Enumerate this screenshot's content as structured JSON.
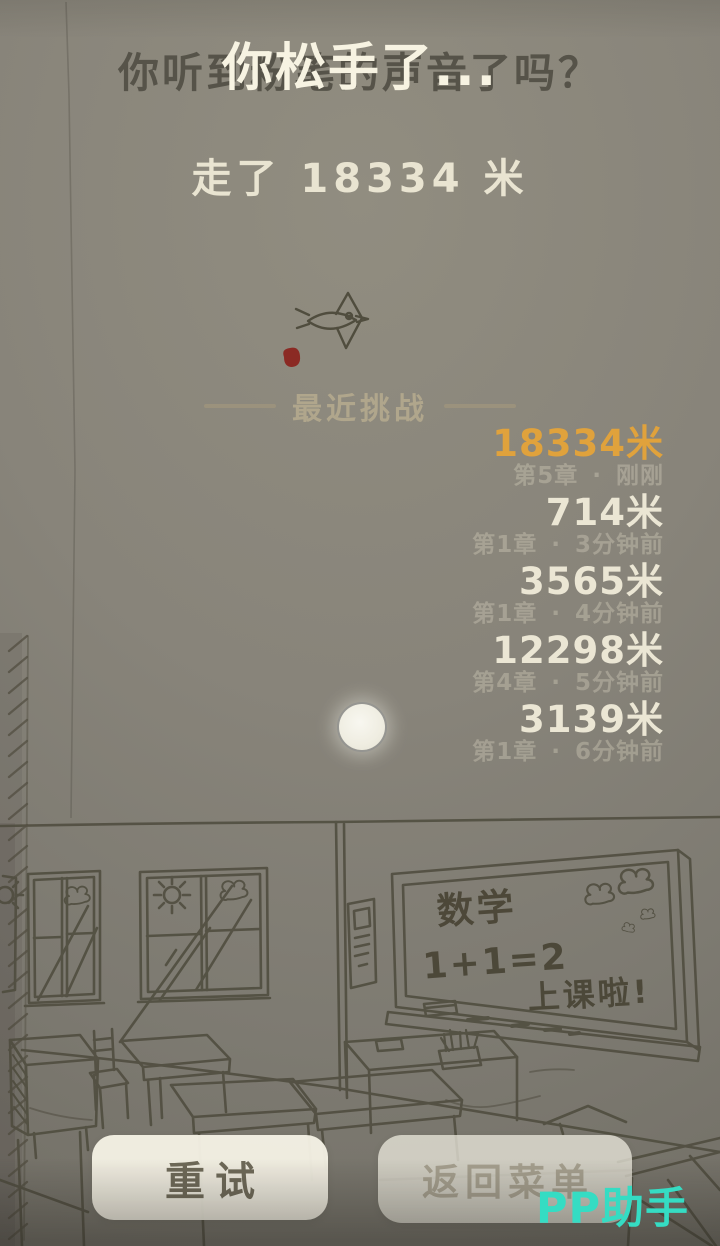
{
  "header": {
    "occluded_question": "你听到粉笔的声音了吗？",
    "title": "你松手了..."
  },
  "result": {
    "distance_text": "走了 18334 米"
  },
  "recent_challenges": {
    "heading": "最近挑战",
    "separator": "·",
    "entries": [
      {
        "distance": "18334米",
        "chapter": "第5章",
        "time_ago": "刚刚"
      },
      {
        "distance": "714米",
        "chapter": "第1章",
        "time_ago": "3分钟前"
      },
      {
        "distance": "3565米",
        "chapter": "第1章",
        "time_ago": "4分钟前"
      },
      {
        "distance": "12298米",
        "chapter": "第4章",
        "time_ago": "5分钟前"
      },
      {
        "distance": "3139米",
        "chapter": "第1章",
        "time_ago": "6分钟前"
      }
    ]
  },
  "blackboard": {
    "subject": "数学",
    "equation": "1+1=2",
    "note": "上课啦!"
  },
  "buttons": {
    "retry": "重试",
    "back_to_menu": "返回菜单"
  },
  "watermark": "PP助手",
  "colors": {
    "background": "#87837a",
    "latest_highlight": "#e0a23c",
    "text_cream": "#ebe6d4",
    "sketch_line": "#4d4a3c",
    "watermark_cyan": "#35dcc3",
    "red_dot": "#8b2a24"
  }
}
